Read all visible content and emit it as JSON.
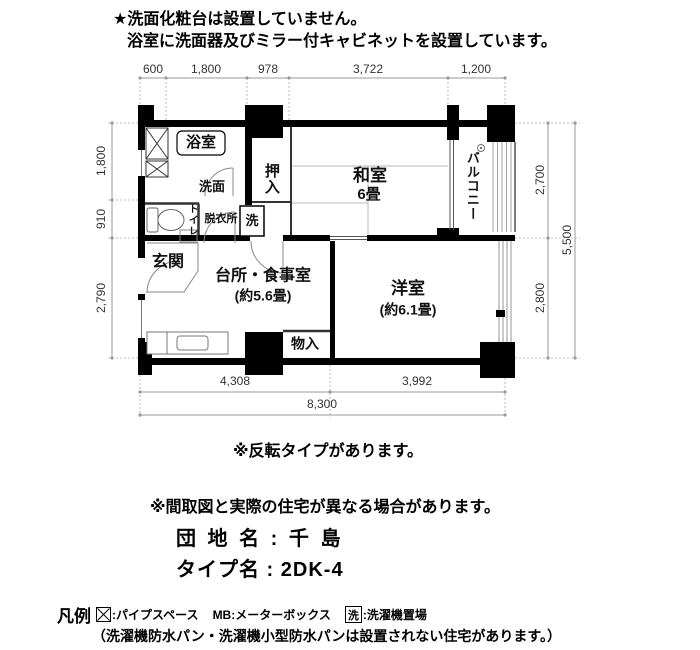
{
  "notes": {
    "line1": "★洗面化粧台は設置していません。",
    "line2": "浴室に洗面器及びミラー付キャビネットを設置しています。"
  },
  "floor_plan": {
    "rooms": {
      "bathroom": "浴室",
      "washbasin": "洗面",
      "closet": "押入",
      "japanese_room": "和室",
      "japanese_room_size": "6畳",
      "balcony": "バルコニー",
      "toilet": "トイレ",
      "dressing_room": "脱衣所",
      "laundry": "洗",
      "entrance": "玄関",
      "kitchen_dining": "台所・食事室",
      "kitchen_dining_size": "(約5.6畳)",
      "western_room": "洋室",
      "western_room_size": "(約6.1畳)",
      "storage": "物入"
    },
    "dimensions": {
      "top": [
        "600",
        "1,800",
        "978",
        "3,722",
        "1,200"
      ],
      "left": [
        "1,800",
        "910",
        "2,790"
      ],
      "right": [
        "2,700",
        "2,800"
      ],
      "right_total": "5,500",
      "bottom": [
        "4,308",
        "3,992"
      ],
      "bottom_total": "8,300"
    }
  },
  "remarks": {
    "line1": "※反転タイプがあります。",
    "line2": "※間取図と実際の住宅が異なる場合があります。"
  },
  "property": {
    "estate_label": "団 地 名 : 千 島",
    "type_label": "タイプ名 : 2DK-4"
  },
  "legend": {
    "title": "凡例",
    "pipe_space_label": ":パイプスペース",
    "meter_box_label": "MB:メーターボックス",
    "laundry_symbol": "洗",
    "laundry_label": ":洗濯機置場",
    "note": "（洗濯機防水パン・洗濯機小型防水パンは設置されない住宅があります。）"
  },
  "colors": {
    "ink": "#000000",
    "paper": "#ffffff",
    "dimension_line": "#999999"
  }
}
